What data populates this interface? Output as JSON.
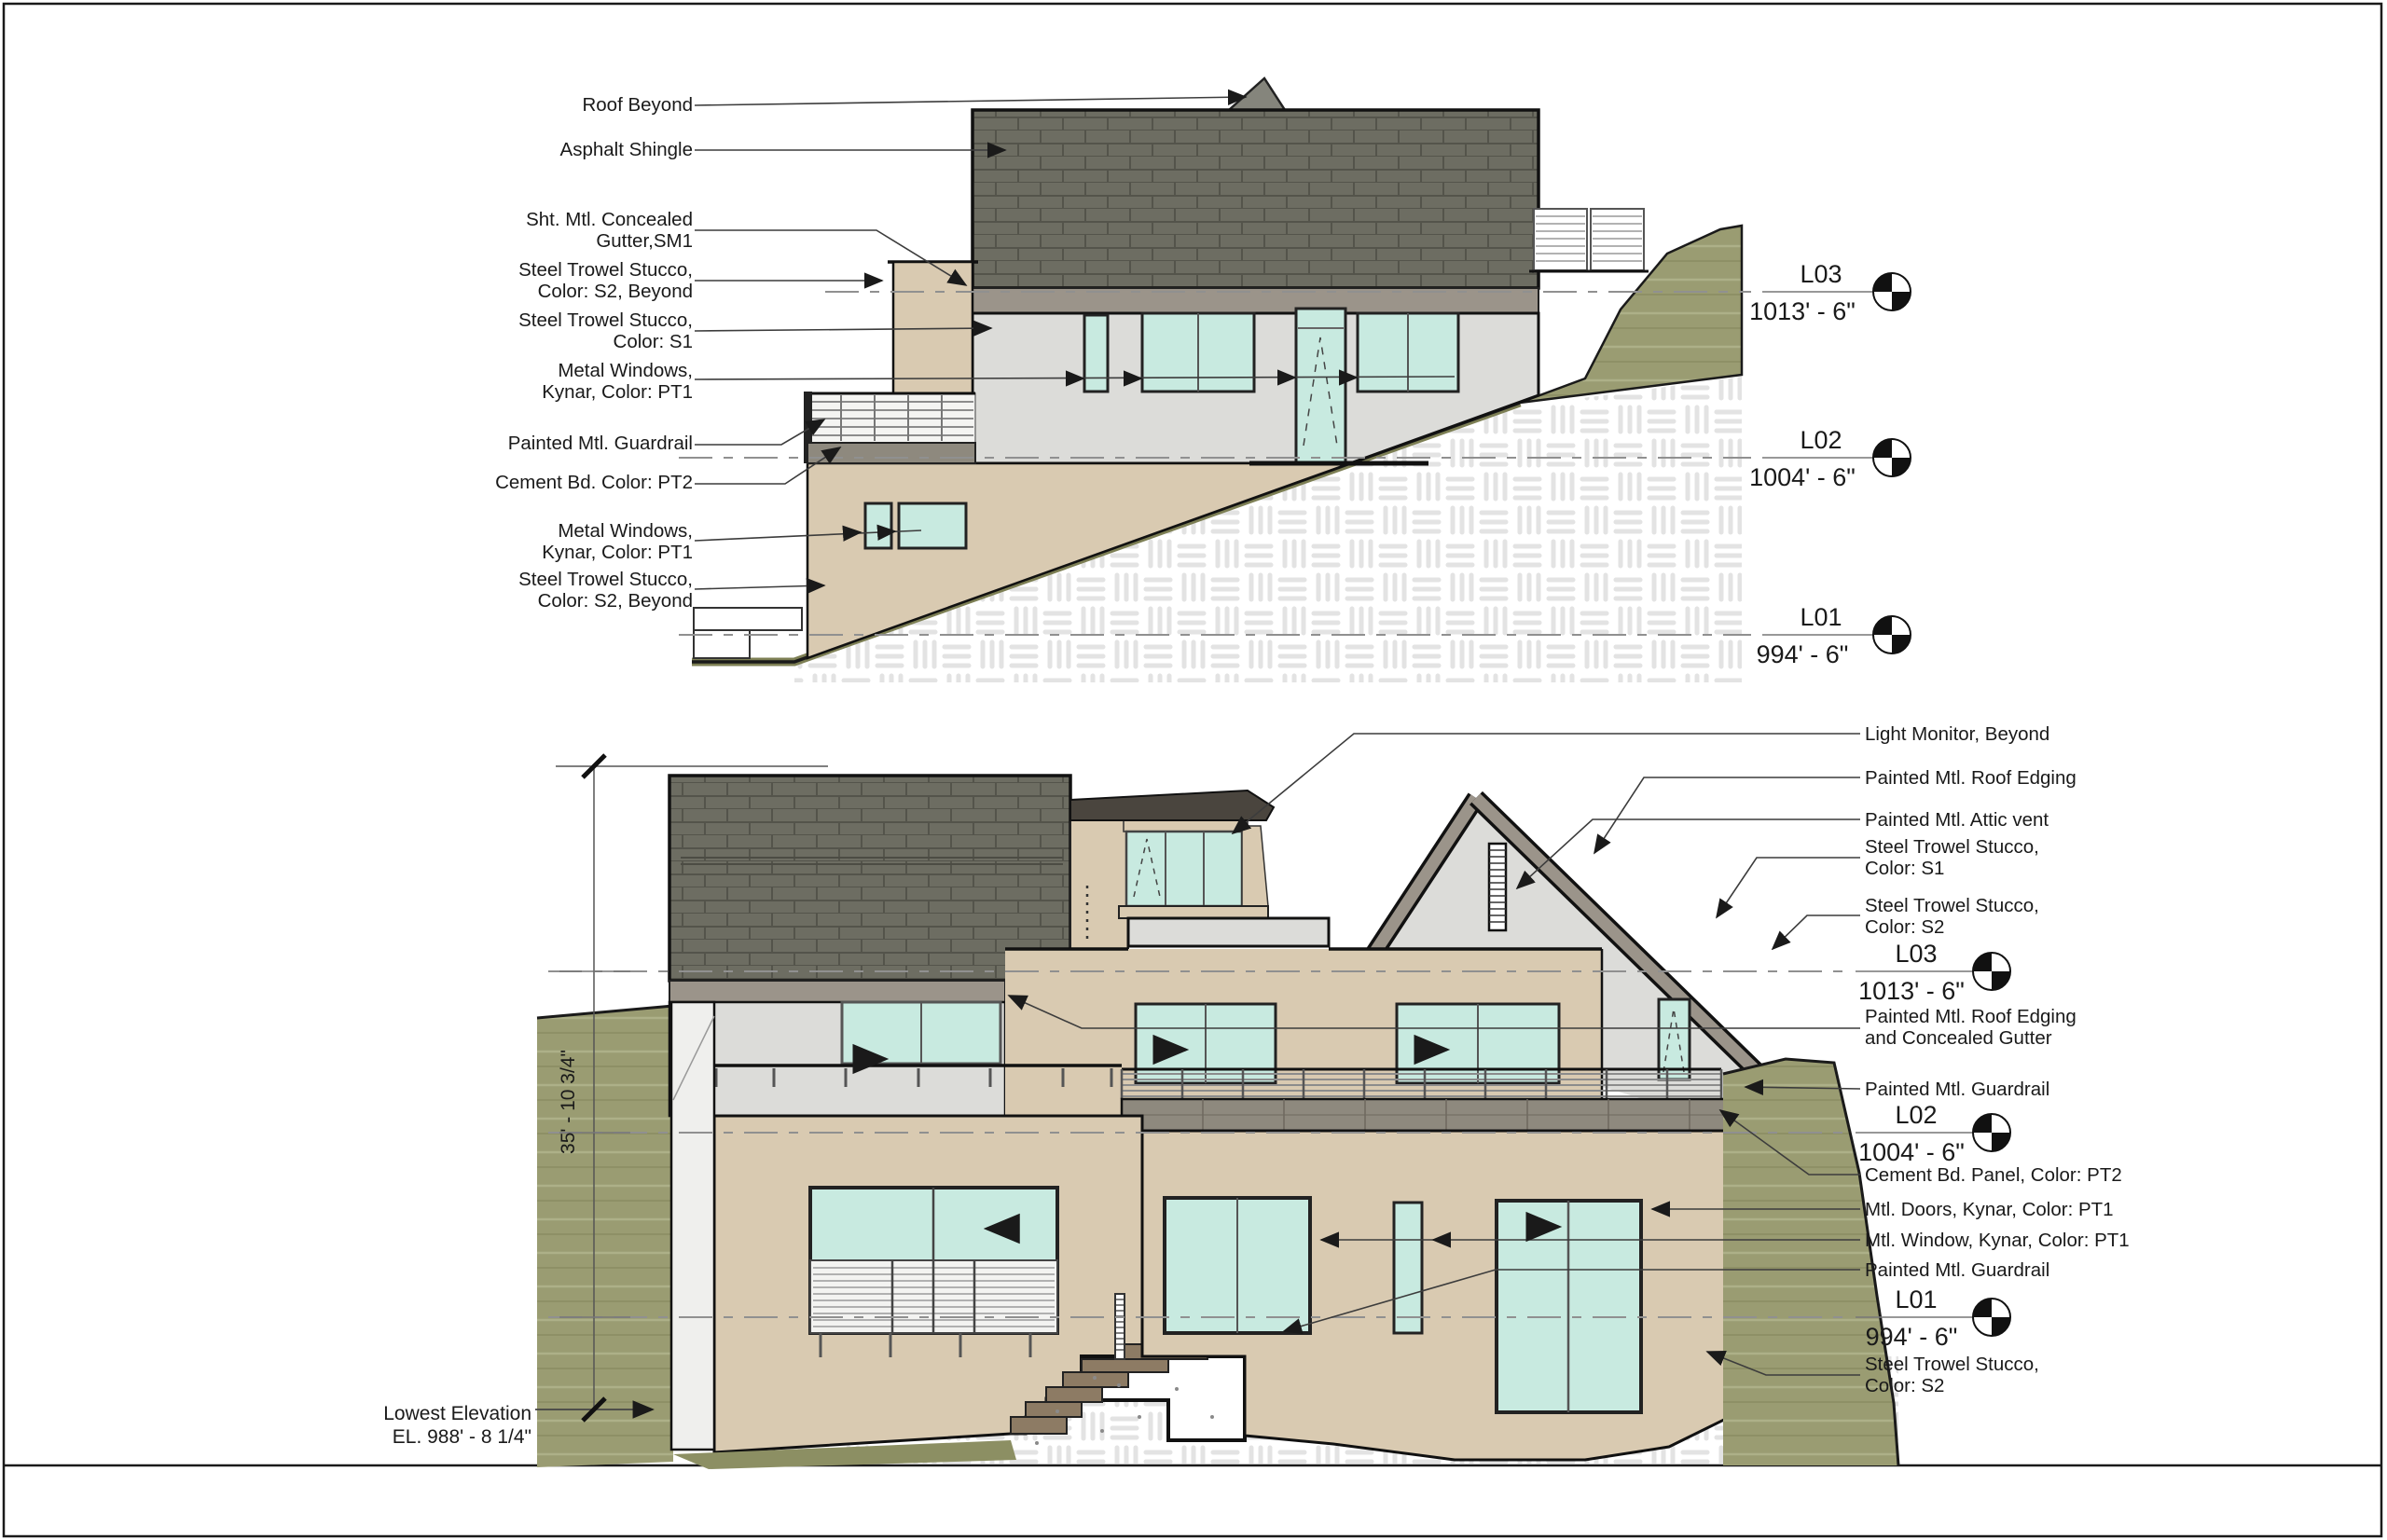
{
  "sheet": {
    "type": "architectural-elevation-sheet"
  },
  "levels": [
    {
      "name": "L03",
      "elevation": "1013' - 6\""
    },
    {
      "name": "L02",
      "elevation": "1004' - 6\""
    },
    {
      "name": "L01",
      "elevation": "994' - 6\""
    }
  ],
  "top_elevation": {
    "labels": [
      "Roof Beyond",
      "Asphalt Shingle",
      "Sht. Mtl. Concealed\nGutter,SM1",
      "Steel Trowel Stucco,\nColor: S2, Beyond",
      "Steel Trowel Stucco,\nColor: S1",
      "Metal Windows,\nKynar, Color: PT1",
      "Painted Mtl. Guardrail",
      "Cement Bd. Color: PT2",
      "Metal Windows,\nKynar, Color: PT1",
      "Steel Trowel Stucco,\nColor: S2, Beyond"
    ]
  },
  "bottom_elevation": {
    "labels": [
      "Light Monitor, Beyond",
      "Painted Mtl. Roof Edging",
      "Painted Mtl. Attic vent",
      "Steel Trowel Stucco,\nColor: S1",
      "Steel Trowel Stucco,\nColor: S2",
      "Painted Mtl. Roof Edging\nand Concealed Gutter",
      "Painted Mtl. Guardrail",
      "Cement Bd. Panel, Color: PT2",
      "Mtl. Doors, Kynar, Color: PT1",
      "Mtl. Window, Kynar, Color: PT1",
      "Painted Mtl. Guardrail",
      "Steel Trowel Stucco,\nColor: S2"
    ],
    "dimension": "35' - 10 3/4\"",
    "lowest_elevation_label": "Lowest  Elevation\nEL. 988' - 8 1/4\""
  },
  "colors": {
    "shingle": "#6d6d62",
    "fascia": "#9b948a",
    "stucco_s1_light": "#dcdcd9",
    "stucco_s2_tan": "#d9cab1",
    "glass": "#c8eae0",
    "cement_panel": "#8e897e",
    "hill_green": "#9a9c72",
    "grade_olive": "#7d7f54",
    "step_brown": "#8d7b64",
    "dashed_level_line": "#909090",
    "line_black": "#1a1a1a"
  }
}
